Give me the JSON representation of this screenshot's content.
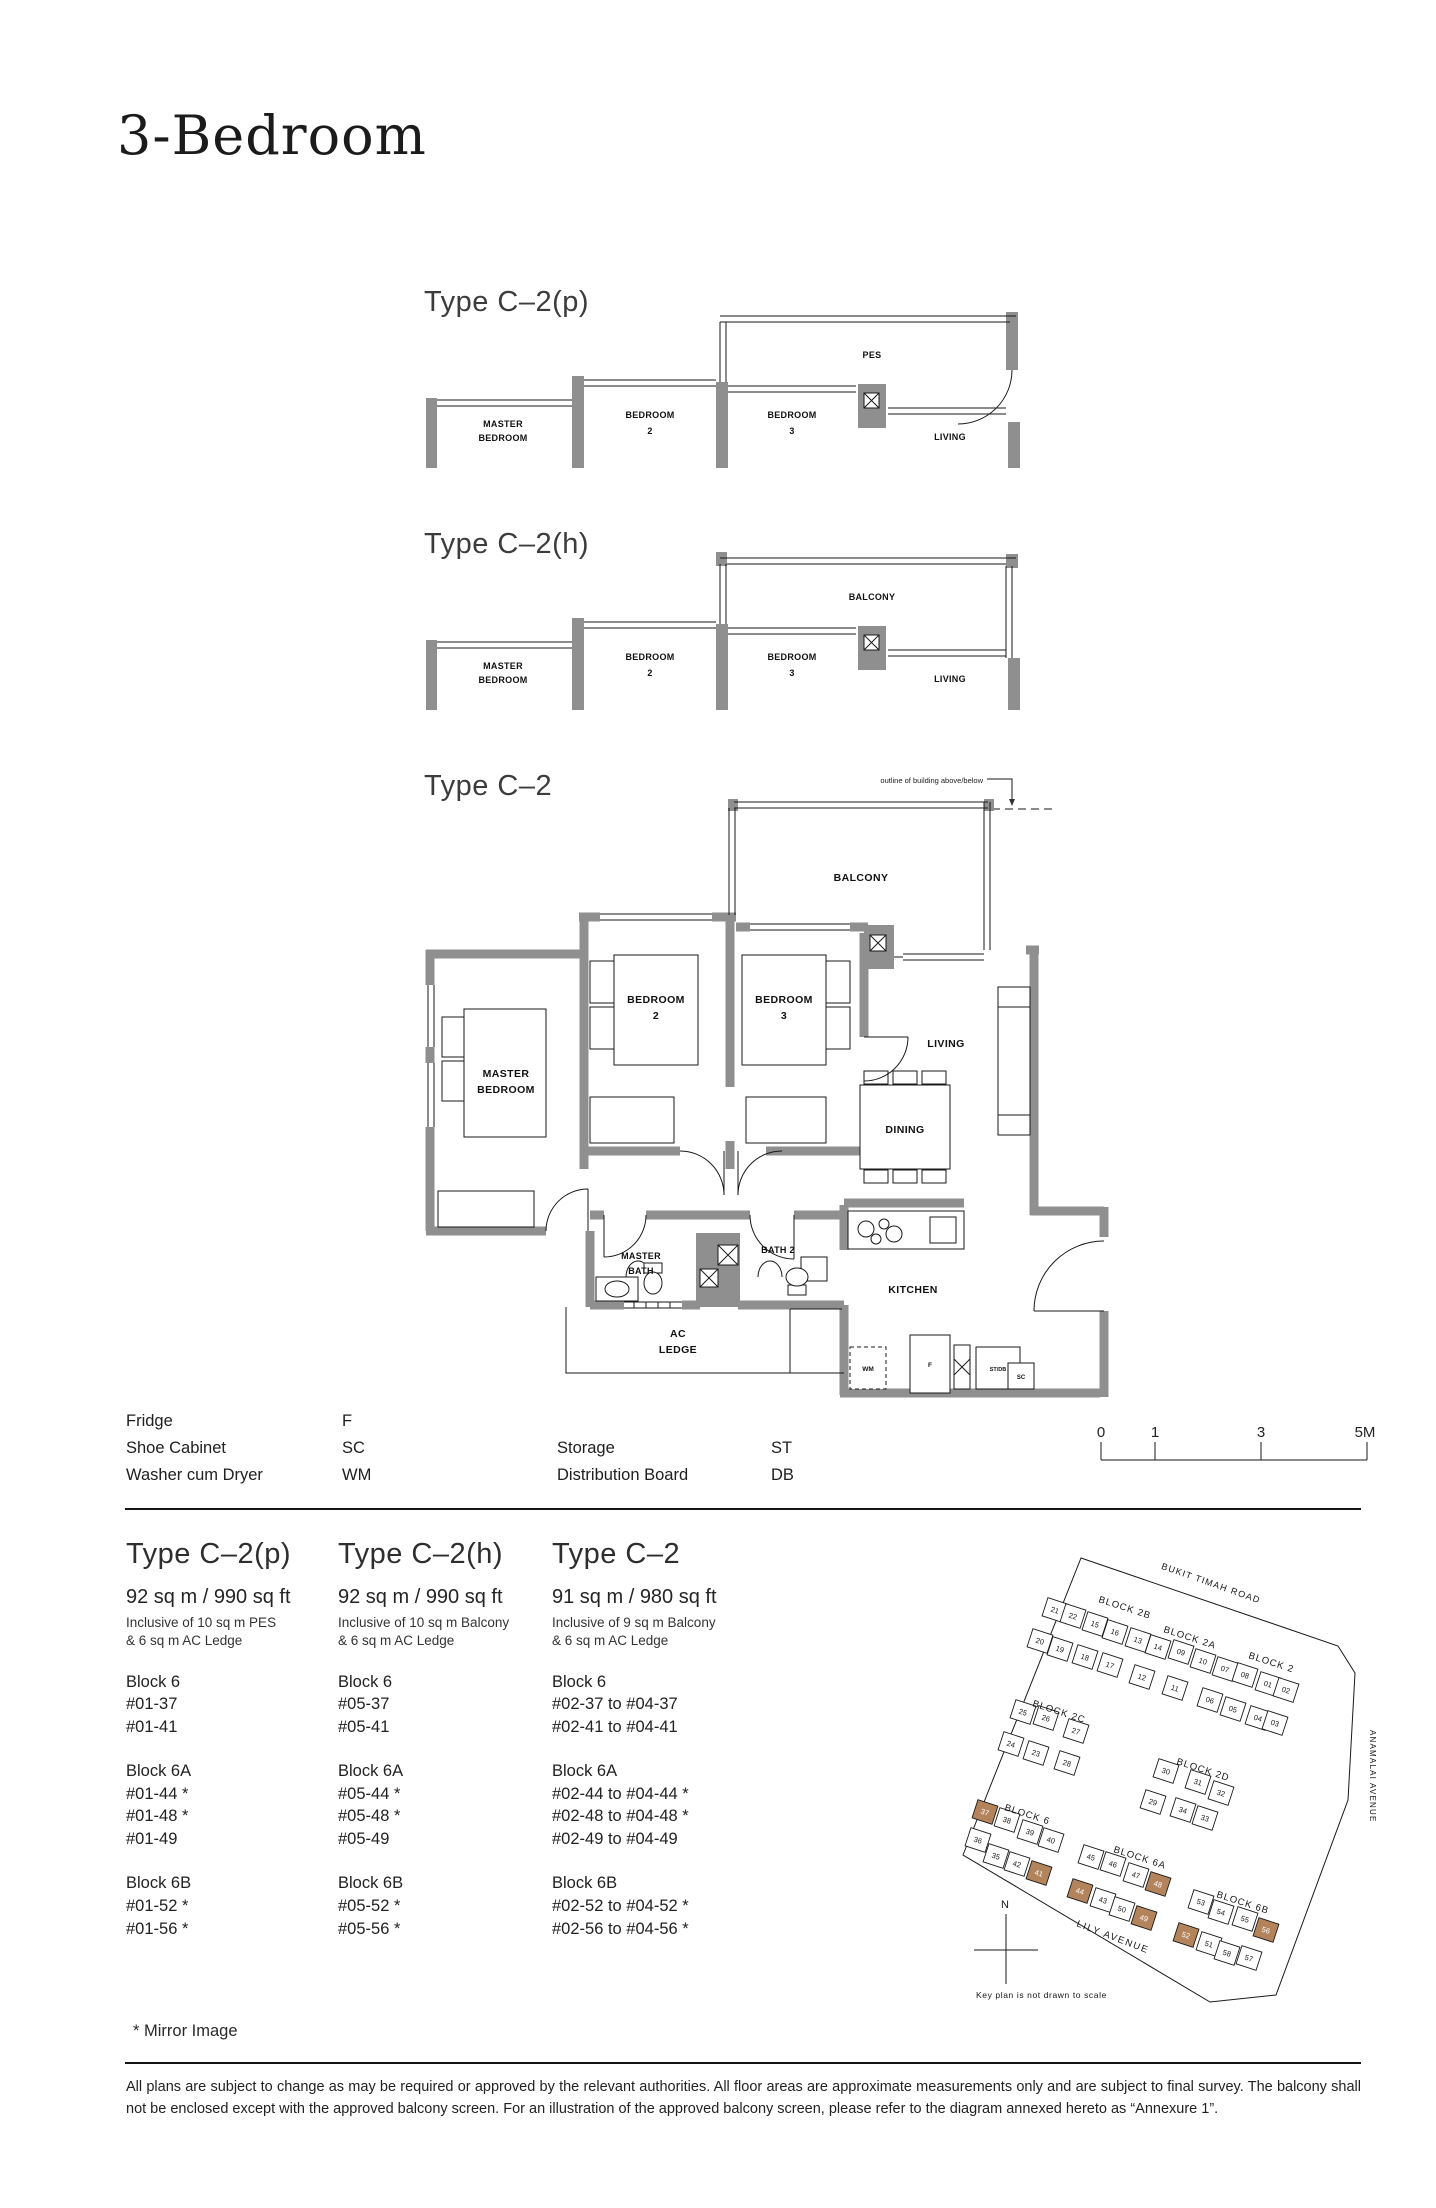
{
  "page": {
    "title": "3-Bedroom",
    "footnote": "* Mirror Image",
    "disclaimer": "All plans are subject to change as may be required or approved by the relevant authorities. All floor areas are approximate measurements only and are subject to final survey. The balcony shall not be enclosed except with the approved balcony screen. For an illustration of the approved balcony screen, please refer to the diagram annexed hereto as “Annexure 1”."
  },
  "plans": {
    "p": {
      "title": "Type C–2(p)",
      "outdoor": "PES",
      "master": [
        "MASTER",
        "BEDROOM"
      ],
      "bed2": [
        "BEDROOM",
        "2"
      ],
      "bed3": [
        "BEDROOM",
        "3"
      ],
      "living": "LIVING"
    },
    "h": {
      "title": "Type C–2(h)",
      "outdoor": "BALCONY",
      "master": [
        "MASTER",
        "BEDROOM"
      ],
      "bed2": [
        "BEDROOM",
        "2"
      ],
      "bed3": [
        "BEDROOM",
        "3"
      ],
      "living": "LIVING"
    },
    "main": {
      "title": "Type C–2",
      "annotation": "outline of building above/below",
      "balcony": "BALCONY",
      "master": [
        "MASTER",
        "BEDROOM"
      ],
      "bed2": [
        "BEDROOM",
        "2"
      ],
      "bed3": [
        "BEDROOM",
        "3"
      ],
      "living": "LIVING",
      "dining": "DINING",
      "masterbath": [
        "MASTER",
        "BATH"
      ],
      "bath2": "BATH 2",
      "acledge": [
        "AC",
        "LEDGE"
      ],
      "kitchen": "KITCHEN",
      "wm": "WM",
      "f": "F",
      "stdb": "ST/DB",
      "sc": "SC"
    }
  },
  "legend": {
    "left": [
      {
        "label": "Fridge",
        "code": "F"
      },
      {
        "label": "Shoe Cabinet",
        "code": "SC"
      },
      {
        "label": "Washer cum Dryer",
        "code": "WM"
      }
    ],
    "right": [
      {
        "label": "Storage",
        "code": "ST"
      },
      {
        "label": "Distribution Board",
        "code": "DB"
      }
    ]
  },
  "scalebar": {
    "ticks": [
      "0",
      "1",
      "3",
      "5M"
    ]
  },
  "types": [
    {
      "name": "Type C–2(p)",
      "area": "92 sq m / 990 sq ft",
      "inclusive": [
        "Inclusive of 10 sq m PES",
        "& 6 sq m AC Ledge"
      ],
      "groups": [
        {
          "block": "Block 6",
          "units": [
            "#01-37",
            "#01-41"
          ]
        },
        {
          "block": "Block 6A",
          "units": [
            "#01-44 *",
            "#01-48 *",
            "#01-49"
          ]
        },
        {
          "block": "Block 6B",
          "units": [
            "#01-52 *",
            "#01-56 *"
          ]
        }
      ]
    },
    {
      "name": "Type C–2(h)",
      "area": "92 sq m / 990 sq ft",
      "inclusive": [
        "Inclusive of 10 sq m Balcony",
        "& 6 sq m AC Ledge"
      ],
      "groups": [
        {
          "block": "Block 6",
          "units": [
            "#05-37",
            "#05-41"
          ]
        },
        {
          "block": "Block 6A",
          "units": [
            "#05-44 *",
            "#05-48 *",
            "#05-49"
          ]
        },
        {
          "block": "Block 6B",
          "units": [
            "#05-52 *",
            "#05-56 *"
          ]
        }
      ]
    },
    {
      "name": "Type C–2",
      "area": "91 sq m / 980 sq ft",
      "inclusive": [
        "Inclusive of 9 sq m Balcony",
        "& 6 sq m AC Ledge"
      ],
      "groups": [
        {
          "block": "Block 6",
          "units": [
            "#02-37  to  #04-37",
            "#02-41  to  #04-41"
          ]
        },
        {
          "block": "Block 6A",
          "units": [
            "#02-44  to  #04-44 *",
            "#02-48  to  #04-48 *",
            "#02-49  to  #04-49"
          ]
        },
        {
          "block": "Block 6B",
          "units": [
            "#02-52  to  #04-52 *",
            "#02-56  to  #04-56 *"
          ]
        }
      ]
    }
  ],
  "keyplan": {
    "roads": {
      "top": "BUKIT TIMAH ROAD",
      "right": "ANAMALAI AVENUE",
      "bottom": "LILY AVENUE"
    },
    "compass": "N",
    "caption": "Key plan is not drawn to scale",
    "highlight_color": "#b3835c",
    "blocks": [
      {
        "label": "BLOCK 2B",
        "lx": 140,
        "ly": 62,
        "units": [
          {
            "n": "21",
            "x": 97,
            "y": 70
          },
          {
            "n": "22",
            "x": 115,
            "y": 76
          },
          {
            "n": "15",
            "x": 137,
            "y": 84
          },
          {
            "n": "16",
            "x": 157,
            "y": 92
          },
          {
            "n": "20",
            "x": 82,
            "y": 101
          },
          {
            "n": "19",
            "x": 102,
            "y": 109
          },
          {
            "n": "18",
            "x": 127,
            "y": 117
          },
          {
            "n": "17",
            "x": 152,
            "y": 125
          }
        ]
      },
      {
        "label": "BLOCK 2A",
        "lx": 205,
        "ly": 92,
        "units": [
          {
            "n": "13",
            "x": 180,
            "y": 100
          },
          {
            "n": "14",
            "x": 200,
            "y": 107
          },
          {
            "n": "09",
            "x": 223,
            "y": 112
          },
          {
            "n": "10",
            "x": 245,
            "y": 121
          },
          {
            "n": "12",
            "x": 184,
            "y": 137
          },
          {
            "n": "11",
            "x": 217,
            "y": 148
          }
        ]
      },
      {
        "label": "BLOCK 2",
        "lx": 290,
        "ly": 118,
        "units": [
          {
            "n": "07",
            "x": 267,
            "y": 129
          },
          {
            "n": "08",
            "x": 287,
            "y": 135
          },
          {
            "n": "01",
            "x": 310,
            "y": 144
          },
          {
            "n": "02",
            "x": 328,
            "y": 150
          },
          {
            "n": "06",
            "x": 252,
            "y": 160
          },
          {
            "n": "05",
            "x": 275,
            "y": 169
          },
          {
            "n": "04",
            "x": 300,
            "y": 178
          },
          {
            "n": "03",
            "x": 317,
            "y": 183
          }
        ]
      },
      {
        "label": "BLOCK 2C",
        "lx": 74,
        "ly": 166,
        "units": [
          {
            "n": "25",
            "x": 65,
            "y": 172
          },
          {
            "n": "26",
            "x": 88,
            "y": 178
          },
          {
            "n": "27",
            "x": 118,
            "y": 191
          },
          {
            "n": "24",
            "x": 53,
            "y": 204
          },
          {
            "n": "23",
            "x": 78,
            "y": 213
          },
          {
            "n": "28",
            "x": 109,
            "y": 223
          }
        ]
      },
      {
        "label": "BLOCK 2D",
        "lx": 218,
        "ly": 224,
        "units": [
          {
            "n": "30",
            "x": 208,
            "y": 231
          },
          {
            "n": "31",
            "x": 240,
            "y": 242
          },
          {
            "n": "32",
            "x": 263,
            "y": 253
          },
          {
            "n": "29",
            "x": 195,
            "y": 262
          },
          {
            "n": "34",
            "x": 225,
            "y": 270
          },
          {
            "n": "33",
            "x": 247,
            "y": 278
          }
        ]
      },
      {
        "label": "BLOCK 6",
        "lx": 46,
        "ly": 270,
        "units": [
          {
            "n": "37",
            "x": 27,
            "y": 272,
            "hl": true
          },
          {
            "n": "38",
            "x": 49,
            "y": 280
          },
          {
            "n": "39",
            "x": 72,
            "y": 292
          },
          {
            "n": "40",
            "x": 93,
            "y": 300
          },
          {
            "n": "36",
            "x": 20,
            "y": 300
          },
          {
            "n": "35",
            "x": 38,
            "y": 316
          },
          {
            "n": "42",
            "x": 59,
            "y": 324
          },
          {
            "n": "41",
            "x": 81,
            "y": 333,
            "hl": true
          }
        ]
      },
      {
        "label": "BLOCK 6A",
        "lx": 155,
        "ly": 312,
        "units": [
          {
            "n": "45",
            "x": 133,
            "y": 317
          },
          {
            "n": "46",
            "x": 155,
            "y": 324
          },
          {
            "n": "47",
            "x": 178,
            "y": 335
          },
          {
            "n": "48",
            "x": 200,
            "y": 344,
            "hl": true
          },
          {
            "n": "44",
            "x": 122,
            "y": 351,
            "hl": true
          },
          {
            "n": "43",
            "x": 145,
            "y": 360
          },
          {
            "n": "50",
            "x": 164,
            "y": 369
          },
          {
            "n": "49",
            "x": 186,
            "y": 378,
            "hl": true
          }
        ]
      },
      {
        "label": "BLOCK 6B",
        "lx": 258,
        "ly": 357,
        "units": [
          {
            "n": "53",
            "x": 243,
            "y": 362
          },
          {
            "n": "54",
            "x": 263,
            "y": 372
          },
          {
            "n": "55",
            "x": 287,
            "y": 379
          },
          {
            "n": "56",
            "x": 308,
            "y": 390,
            "hl": true
          },
          {
            "n": "52",
            "x": 228,
            "y": 395,
            "hl": true
          },
          {
            "n": "51",
            "x": 251,
            "y": 404
          },
          {
            "n": "58",
            "x": 269,
            "y": 413
          },
          {
            "n": "57",
            "x": 291,
            "y": 418
          }
        ]
      }
    ]
  }
}
